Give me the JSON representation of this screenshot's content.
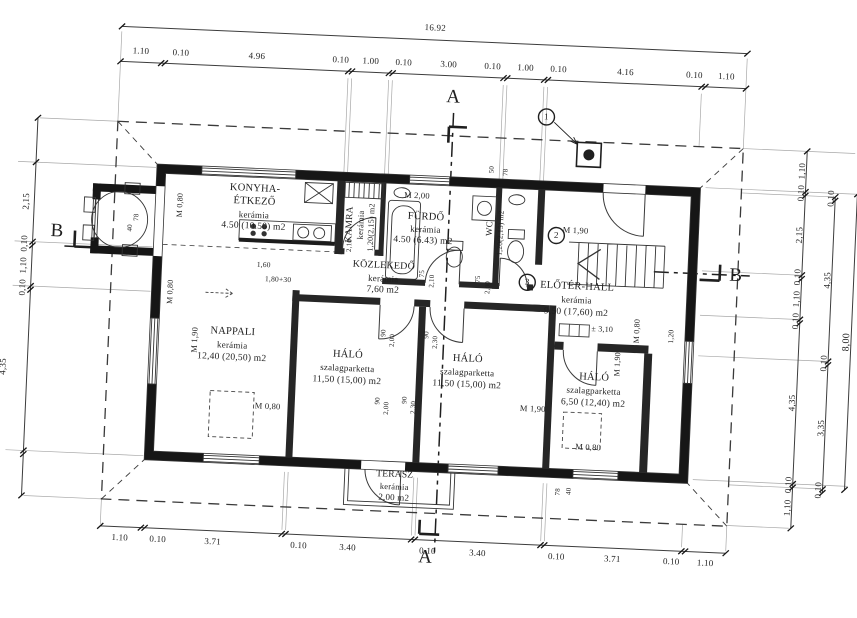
{
  "colors": {
    "paper": "#ffffff",
    "ink": "#1a1a1a",
    "wall": "#161616",
    "thin_line": "#3c3c3c",
    "construction": "#9f9f9f"
  },
  "drawing_type": "architectural floor plan (földszinti alaprajz)",
  "section_markers": [
    "A",
    "B"
  ],
  "detail_markers": [
    "1",
    "2",
    "3"
  ],
  "dimension_chains": {
    "top_total": "16.92",
    "top": [
      "1.10",
      "0.10",
      "4.96",
      "0.10",
      "1.00",
      "0.10",
      "3.00",
      "0.10",
      "1.00",
      "0.10",
      "4.16",
      "0.10",
      "1.10"
    ],
    "bottom": [
      "1.10",
      "0.10",
      "3.71",
      "0.10",
      "3.40",
      "0.10",
      "3.40",
      "0.10",
      "3.71",
      "0.10",
      "1.10"
    ],
    "left": [
      "2,15",
      "0,10",
      "1,10",
      "0,10",
      "4,35"
    ],
    "right_inner": [
      "1,10",
      "0,10",
      "2,15",
      "0,10",
      "1,10",
      "0,10",
      "4,35",
      "0,10",
      "1,10"
    ],
    "right_middle": [
      "0,10",
      "4,35",
      "0,10",
      "3,35",
      "0,10"
    ],
    "right_total": "8,00"
  },
  "rooms": [
    {
      "name": "KONYHA-ÉTKEZŐ",
      "floor": "kerámia",
      "area": "4.50 (10.50) m2"
    },
    {
      "name": "KAMRA",
      "floor": "kerámia",
      "area": "1,20(2,15) m2"
    },
    {
      "name": "FÜRDŐ",
      "floor": "kerámia",
      "area": "4.50 (6.43) m2",
      "parapet": "M 2,00"
    },
    {
      "name": "WC",
      "area": "1,20(2,15) m2"
    },
    {
      "name": "KÖZLEKEDŐ",
      "floor": "kerámia",
      "area": "7,60 m2"
    },
    {
      "name": "ELŐTÉR-HALL",
      "floor": "kerámia",
      "area": "9,50 (17,60) m2",
      "level": "± 3,10",
      "parapet": "M 1,90"
    },
    {
      "name": "NAPPALI",
      "floor": "kerámia",
      "area": "12,40 (20,50) m2"
    },
    {
      "name": "HÁLÓ",
      "floor": "szalagparketta",
      "area": "11,50 (15,00) m2"
    },
    {
      "name": "HÁLÓ",
      "floor": "szalagparketta",
      "area": "11,50 (15,00) m2"
    },
    {
      "name": "HÁLÓ",
      "floor": "szalagparketta",
      "area": "6,50 (12,40) m2"
    },
    {
      "name": "TERASZ",
      "floor": "kerámia",
      "area": "2,00 m2"
    }
  ],
  "labels": [
    {
      "n": "dim-top-total",
      "t": "16.92",
      "x": 423,
      "y": 28
    },
    {
      "n": "dim-top-1",
      "t": "1.10",
      "x": 130,
      "y": 64
    },
    {
      "n": "dim-top-2",
      "t": "0.10",
      "x": 170,
      "y": 64
    },
    {
      "n": "dim-top-3",
      "t": "4.96",
      "x": 246,
      "y": 64
    },
    {
      "n": "dim-top-4",
      "t": "0.10",
      "x": 330,
      "y": 64
    },
    {
      "n": "dim-top-5",
      "t": "1.00",
      "x": 360,
      "y": 64
    },
    {
      "n": "dim-top-6",
      "t": "0.10",
      "x": 393,
      "y": 64
    },
    {
      "n": "dim-top-7",
      "t": "3.00",
      "x": 438,
      "y": 64
    },
    {
      "n": "dim-top-8",
      "t": "0.10",
      "x": 482,
      "y": 64
    },
    {
      "n": "dim-top-9",
      "t": "1.00",
      "x": 515,
      "y": 64
    },
    {
      "n": "dim-top-10",
      "t": "0.10",
      "x": 548,
      "y": 64
    },
    {
      "n": "dim-top-11",
      "t": "4.16",
      "x": 615,
      "y": 64
    },
    {
      "n": "dim-top-12",
      "t": "0.10",
      "x": 684,
      "y": 64
    },
    {
      "n": "dim-top-13",
      "t": "1.10",
      "x": 716,
      "y": 64
    },
    {
      "n": "dim-bottom-1",
      "t": "1.10",
      "x": 130,
      "y": 551
    },
    {
      "n": "dim-bottom-2",
      "t": "0.10",
      "x": 168,
      "y": 551
    },
    {
      "n": "dim-bottom-3",
      "t": "3.71",
      "x": 223,
      "y": 551
    },
    {
      "n": "dim-bottom-4",
      "t": "0.10",
      "x": 309,
      "y": 551
    },
    {
      "n": "dim-bottom-5",
      "t": "3.40",
      "x": 358,
      "y": 551
    },
    {
      "n": "dim-bottom-6",
      "t": "0.10",
      "x": 438,
      "y": 551
    },
    {
      "n": "dim-bottom-7",
      "t": "3.40",
      "x": 488,
      "y": 551
    },
    {
      "n": "dim-bottom-8",
      "t": "0.10",
      "x": 567,
      "y": 551
    },
    {
      "n": "dim-bottom-9",
      "t": "3.71",
      "x": 623,
      "y": 551
    },
    {
      "n": "dim-bottom-10",
      "t": "0.10",
      "x": 682,
      "y": 551
    },
    {
      "n": "dim-bottom-11",
      "t": "1.10",
      "x": 716,
      "y": 551
    },
    {
      "n": "dim-left-1",
      "t": "2,15",
      "x": 22,
      "y": 219,
      "r": -90
    },
    {
      "n": "dim-left-2",
      "t": "0,10",
      "x": 22,
      "y": 261,
      "r": -90
    },
    {
      "n": "dim-left-3",
      "t": "1,10",
      "x": 22,
      "y": 283,
      "r": -90
    },
    {
      "n": "dim-left-4",
      "t": "0,10",
      "x": 22,
      "y": 305,
      "r": -90
    },
    {
      "n": "dim-left-5",
      "t": "4,35",
      "x": 6,
      "y": 385,
      "r": -90
    },
    {
      "n": "dim-right-1",
      "t": "1,10",
      "x": 796,
      "y": 155,
      "r": -90
    },
    {
      "n": "dim-right-2",
      "t": "0,10",
      "x": 796,
      "y": 177,
      "r": -90
    },
    {
      "n": "dim-right-3",
      "t": "2,15",
      "x": 796,
      "y": 219,
      "r": -90
    },
    {
      "n": "dim-right-4",
      "t": "0,10",
      "x": 796,
      "y": 261,
      "r": -90
    },
    {
      "n": "dim-right-5",
      "t": "1,10",
      "x": 796,
      "y": 283,
      "r": -90
    },
    {
      "n": "dim-right-6",
      "t": "0,10",
      "x": 796,
      "y": 305,
      "r": -90
    },
    {
      "n": "dim-right-7",
      "t": "4,35",
      "x": 796,
      "y": 387,
      "r": -90
    },
    {
      "n": "dim-right-8",
      "t": "0,10",
      "x": 796,
      "y": 469,
      "r": -90
    },
    {
      "n": "dim-right-9",
      "t": "1,10",
      "x": 796,
      "y": 492,
      "r": -90
    },
    {
      "n": "dim-right-mid-1",
      "t": "0,10",
      "x": 826,
      "y": 181,
      "r": -90
    },
    {
      "n": "dim-right-mid-2",
      "t": "4,35",
      "x": 826,
      "y": 263,
      "r": -90
    },
    {
      "n": "dim-right-mid-3",
      "t": "0,10",
      "x": 826,
      "y": 346,
      "r": -90
    },
    {
      "n": "dim-right-mid-4",
      "t": "3,35",
      "x": 826,
      "y": 411,
      "r": -90
    },
    {
      "n": "dim-right-mid-5",
      "t": "0,10",
      "x": 826,
      "y": 473,
      "r": -90
    },
    {
      "n": "dim-right-total",
      "t": "8,00",
      "x": 848,
      "y": 324,
      "r": -90,
      "s": 10
    },
    {
      "n": "section-a-top",
      "t": "A",
      "x": 444,
      "y": 96,
      "s": 19
    },
    {
      "n": "section-a-bottom",
      "t": "A",
      "x": 436,
      "y": 557,
      "s": 19
    },
    {
      "n": "section-b-left",
      "t": "B",
      "x": 54,
      "y": 247,
      "s": 19
    },
    {
      "n": "section-b-right",
      "t": "B",
      "x": 734,
      "y": 262,
      "s": 19
    },
    {
      "n": "room-kitchen-name-1",
      "t": "KONYHA-",
      "x": 250,
      "y": 197,
      "s": 10.5
    },
    {
      "n": "room-kitchen-name-2",
      "t": "ÉTKEZŐ",
      "x": 250,
      "y": 210,
      "s": 10.5
    },
    {
      "n": "room-kitchen-floor",
      "t": "kerámia",
      "x": 250,
      "y": 223,
      "s": 9
    },
    {
      "n": "room-kitchen-area",
      "t": "4.50 (10.50) m2",
      "x": 250,
      "y": 235,
      "s": 9.5
    },
    {
      "n": "room-pantry-name",
      "t": "KAMRA",
      "x": 347,
      "y": 228,
      "r": -90,
      "s": 9.5
    },
    {
      "n": "room-pantry-floor",
      "t": "kerámia",
      "x": 357,
      "y": 228,
      "r": -90,
      "s": 8.5
    },
    {
      "n": "room-pantry-area",
      "t": "1,20(2,15) m2",
      "x": 368,
      "y": 230,
      "r": -90,
      "s": 8
    },
    {
      "n": "bath-parapet",
      "t": "M 2,00",
      "x": 412,
      "y": 196,
      "s": 8.5
    },
    {
      "n": "room-bath-name",
      "t": "FÜRDŐ",
      "x": 422,
      "y": 218,
      "s": 10.5
    },
    {
      "n": "room-bath-floor",
      "t": "kerámia",
      "x": 422,
      "y": 230,
      "s": 9
    },
    {
      "n": "room-bath-area",
      "t": "4.50 (6.43) m2",
      "x": 420,
      "y": 242,
      "s": 9.5
    },
    {
      "n": "room-wc-name",
      "t": "WC",
      "x": 486,
      "y": 226,
      "r": -90,
      "s": 9
    },
    {
      "n": "room-wc-area",
      "t": "1,20(2,15) m2",
      "x": 497,
      "y": 230,
      "r": -90,
      "s": 7.5
    },
    {
      "n": "room-corridor-name",
      "t": "KÖZLEKEDŐ",
      "x": 382,
      "y": 268,
      "s": 10
    },
    {
      "n": "room-corridor-floor",
      "t": "kerámia",
      "x": 382,
      "y": 281,
      "s": 9
    },
    {
      "n": "room-corridor-area",
      "t": "7,60 m2",
      "x": 382,
      "y": 293,
      "s": 9.5
    },
    {
      "n": "hall-parapet",
      "t": "M 1,90",
      "x": 572,
      "y": 224,
      "s": 8.5
    },
    {
      "n": "room-hall-name",
      "t": "ELŐTÉR-HALL",
      "x": 576,
      "y": 281,
      "s": 10.5
    },
    {
      "n": "room-hall-floor",
      "t": "kerámia",
      "x": 576,
      "y": 294,
      "s": 9
    },
    {
      "n": "room-hall-area",
      "t": "9,50 (17,60) m2",
      "x": 576,
      "y": 307,
      "s": 9.5
    },
    {
      "n": "hall-level",
      "t": "± 3,10",
      "x": 603,
      "y": 322,
      "s": 8
    },
    {
      "n": "living-parapet-west",
      "t": "M 1,90",
      "x": 196,
      "y": 350,
      "r": -90,
      "s": 8.5
    },
    {
      "n": "room-living-name",
      "t": "NAPPALI",
      "x": 234,
      "y": 341,
      "s": 10.5
    },
    {
      "n": "room-living-floor",
      "t": "kerámia",
      "x": 234,
      "y": 354,
      "s": 9
    },
    {
      "n": "room-living-area",
      "t": "12,40 (20,50) m2",
      "x": 234,
      "y": 367,
      "s": 9.5
    },
    {
      "n": "living-parapet-south",
      "t": "M 0,80",
      "x": 272,
      "y": 413,
      "s": 8.5
    },
    {
      "n": "room-bed1-name",
      "t": "HÁLÓ",
      "x": 350,
      "y": 359,
      "s": 10.5
    },
    {
      "n": "room-bed1-floor",
      "t": "szalagparketta",
      "x": 350,
      "y": 372,
      "s": 9
    },
    {
      "n": "room-bed1-area",
      "t": "11,50 (15,00) m2",
      "x": 350,
      "y": 385,
      "s": 9.5
    },
    {
      "n": "room-bed2-name",
      "t": "HÁLÓ",
      "x": 470,
      "y": 358,
      "s": 10.5
    },
    {
      "n": "room-bed2-floor",
      "t": "szalagparketta",
      "x": 470,
      "y": 371,
      "s": 9
    },
    {
      "n": "room-bed2-area",
      "t": "11,50 (15,00) m2",
      "x": 470,
      "y": 384,
      "s": 9.5
    },
    {
      "n": "bed2-parapet",
      "t": "M 1,90",
      "x": 537,
      "y": 404,
      "s": 8.5
    },
    {
      "n": "bed3-parapet-north",
      "t": "M 1,90",
      "x": 620,
      "y": 356,
      "r": -90,
      "s": 8
    },
    {
      "n": "room-bed3-name",
      "t": "HÁLÓ",
      "x": 597,
      "y": 371,
      "s": 10.5
    },
    {
      "n": "room-bed3-floor",
      "t": "szalagparketta",
      "x": 597,
      "y": 384,
      "s": 9
    },
    {
      "n": "room-bed3-area",
      "t": "6,50 (12,40) m2",
      "x": 597,
      "y": 397,
      "s": 9.5
    },
    {
      "n": "bed3-parapet-south",
      "t": "M 0,80",
      "x": 594,
      "y": 440,
      "s": 8.5
    },
    {
      "n": "room-terrace-name",
      "t": "TERASZ",
      "x": 402,
      "y": 477,
      "s": 9.5
    },
    {
      "n": "room-terrace-floor",
      "t": "kerámia",
      "x": 402,
      "y": 488,
      "s": 8.5
    },
    {
      "n": "room-terrace-area",
      "t": "2,00 m2",
      "x": 402,
      "y": 499,
      "s": 9
    },
    {
      "n": "hall-parapet-east",
      "t": "M 0,80",
      "x": 638,
      "y": 322,
      "r": -90,
      "s": 8
    },
    {
      "n": "dim-east-strip",
      "t": "1,20",
      "x": 672,
      "y": 326,
      "r": -90,
      "s": 7.5
    },
    {
      "n": "kitchen-bay-parapet",
      "t": "M 0,80",
      "x": 176,
      "y": 216,
      "r": -90,
      "s": 8
    },
    {
      "n": "living-west-parapet",
      "t": "M 0,80",
      "x": 170,
      "y": 303,
      "r": -90,
      "s": 8
    },
    {
      "n": "dim-kitchen-opening-1",
      "t": "1,60",
      "x": 262,
      "y": 272,
      "s": 7.5
    },
    {
      "n": "dim-kitchen-opening-2",
      "t": "1,80+30",
      "x": 277,
      "y": 286,
      "s": 7.5
    },
    {
      "n": "dim-pantry-door",
      "t": "2,10",
      "x": 347,
      "y": 249,
      "r": -90,
      "s": 7
    },
    {
      "n": "dim-bath-door-w",
      "t": "75",
      "x": 421,
      "y": 274,
      "r": -90,
      "s": 7
    },
    {
      "n": "dim-bath-door-h",
      "t": "2,10",
      "x": 431,
      "y": 281,
      "r": -90,
      "s": 7
    },
    {
      "n": "dim-wc-door-w",
      "t": "75",
      "x": 477,
      "y": 277,
      "r": -90,
      "s": 7
    },
    {
      "n": "dim-wc-door-h",
      "t": "2,00",
      "x": 487,
      "y": 285,
      "r": -90,
      "s": 7
    },
    {
      "n": "dim-top-wall-1",
      "t": "50",
      "x": 486,
      "y": 167,
      "r": -90,
      "s": 7
    },
    {
      "n": "dim-top-wall-2",
      "t": "78",
      "x": 500,
      "y": 169,
      "r": -90,
      "s": 7
    },
    {
      "n": "dim-b-wall-1",
      "t": "78",
      "x": 133,
      "y": 230,
      "r": -90,
      "s": 7
    },
    {
      "n": "dim-b-wall-2",
      "t": "40",
      "x": 127,
      "y": 241,
      "r": -90,
      "s": 7
    },
    {
      "n": "dim-se-wall-1",
      "t": "78",
      "x": 566,
      "y": 486,
      "r": -90,
      "s": 7
    },
    {
      "n": "dim-se-wall-2",
      "t": "40",
      "x": 577,
      "y": 485,
      "r": -90,
      "s": 7
    },
    {
      "n": "dim-door1-w",
      "t": "90",
      "x": 385,
      "y": 335,
      "r": -90,
      "s": 7
    },
    {
      "n": "dim-door1-h",
      "t": "2,00",
      "x": 394,
      "y": 342,
      "r": -90,
      "s": 7
    },
    {
      "n": "dim-door2-w",
      "t": "90",
      "x": 428,
      "y": 335,
      "r": -90,
      "s": 7
    },
    {
      "n": "dim-door2-h",
      "t": "2,30",
      "x": 437,
      "y": 342,
      "r": -90,
      "s": 7
    },
    {
      "n": "dim-door3-w",
      "t": "90",
      "x": 382,
      "y": 403,
      "r": -90,
      "s": 7
    },
    {
      "n": "dim-door3-h",
      "t": "2,00",
      "x": 391,
      "y": 410,
      "r": -90,
      "s": 7
    },
    {
      "n": "dim-door4-w",
      "t": "90",
      "x": 409,
      "y": 401,
      "r": -90,
      "s": 7
    },
    {
      "n": "dim-door4-h",
      "t": "2,30",
      "x": 418,
      "y": 408,
      "r": -90,
      "s": 7
    },
    {
      "n": "detail-marker-1",
      "t": "1",
      "x": 538,
      "y": 112,
      "s": 9
    },
    {
      "n": "detail-marker-2",
      "t": "2",
      "x": 553,
      "y": 230,
      "s": 9
    },
    {
      "n": "detail-marker-3",
      "t": "3",
      "x": 526,
      "y": 278,
      "s": 9
    }
  ]
}
